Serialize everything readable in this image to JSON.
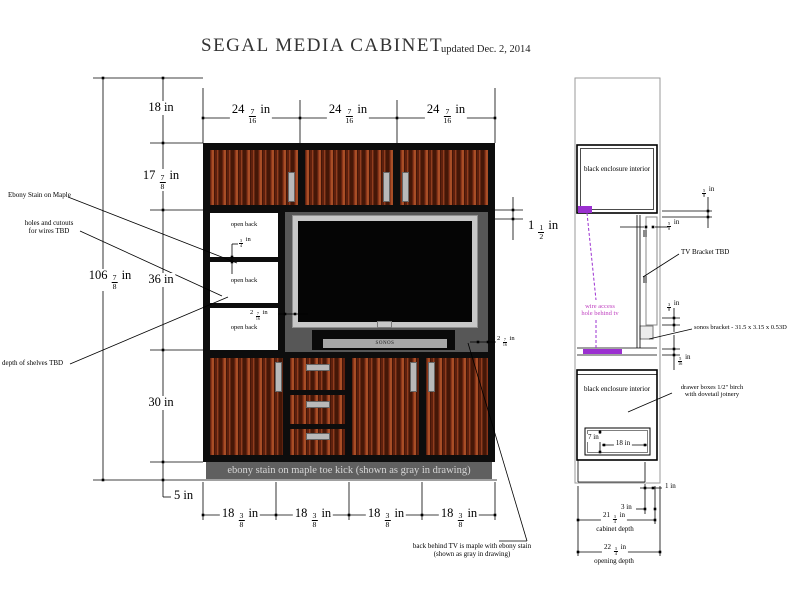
{
  "title": "SEGAL MEDIA CABINET",
  "updated": "updated Dec. 2, 2014",
  "front": {
    "top_dims": [
      "24 7/16 in",
      "24 7/16 in",
      "24 7/16 in"
    ],
    "bottom_dims": [
      "18 3/8 in",
      "18 3/8 in",
      "18 3/8 in",
      "18 3/8 in"
    ],
    "left_dims": {
      "overall": "106 7/8 in",
      "seg_top": "18 in",
      "seg_upper": "17 7/8 in",
      "seg_middle": "36 in",
      "seg_lower": "30 in",
      "seg_toe": "5 in"
    },
    "gap_dim": "1 1/2 in",
    "shelf_dim": "3/4 in",
    "tv_gap_left": "2 7/16 in",
    "tv_gap_right": "2 7/16 in",
    "open_back": [
      "open back",
      "open back",
      "open back"
    ],
    "soundbar_label": "SONOS",
    "toe_kick_label": "ebony stain on maple toe kick (shown as gray in drawing)",
    "annotations": {
      "ebony": "Ebony Stain on Maple",
      "holes_1": "holes and cutouts",
      "holes_2": "for wires TBD",
      "shelves": "depth of shelves TBD",
      "back_tv_1": "back behind TV is maple with ebony stain",
      "back_tv_2": "(shown as gray in drawing)"
    }
  },
  "side": {
    "upper_box_label": "black enclosure interior",
    "lower_box_label": "black enclosure interior",
    "wire_access_1": "wire access",
    "wire_access_2": "hole behind tv",
    "tv_bracket": "TV Bracket TBD",
    "sonos_bracket": "sonos bracket - 31.5 x 3.15 x 0.53D",
    "drawer_note_1": "drawer boxes 1/2\" birch",
    "drawer_note_2": "with dovetail joinery",
    "dims": {
      "top_gap": "5/8 in",
      "back_gap": "5/8 in",
      "above_bracket": "3/8 in",
      "below_bracket": "5/16 in",
      "drawer_height": "7 in",
      "drawer_depth": "18 in",
      "toe_recess": "1 in",
      "toe_depth": "3 in",
      "cabinet_depth_value": "21 3/4 in",
      "cabinet_depth_label": "cabinet depth",
      "opening_depth_value": "22 3/4 in",
      "opening_depth_label": "opening depth"
    }
  },
  "colors": {
    "accent_purple": "#9b30d0",
    "annotation_magenta": "#bf3fbf",
    "wood_light": "#a84e26",
    "wood_mid": "#8a3519",
    "wood_dark": "#5e200d",
    "cabinet_frame": "#0d0d0d",
    "recess_gray": "#575757",
    "bezel_gray": "#c8c8c8",
    "toe_gray": "#606060"
  }
}
